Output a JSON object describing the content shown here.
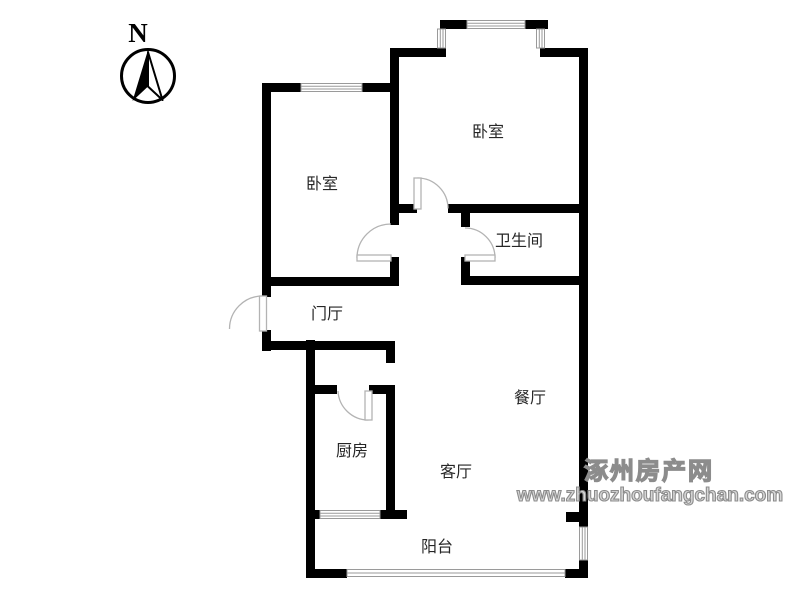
{
  "compass": {
    "label": "N"
  },
  "rooms": {
    "bedroom_top": "卧室",
    "bedroom_left": "卧室",
    "bathroom": "卫生间",
    "entrance_hall": "门厅",
    "dining": "餐厅",
    "kitchen": "厨房",
    "living": "客厅",
    "balcony": "阳台"
  },
  "watermark": {
    "site_name": "涿州房产网",
    "site_url": "www.zhuozhoufangchan.com"
  },
  "colors": {
    "wall": "#000000",
    "window": "#9a9a9a",
    "door": "#b3b3b3",
    "label": "#262626"
  }
}
